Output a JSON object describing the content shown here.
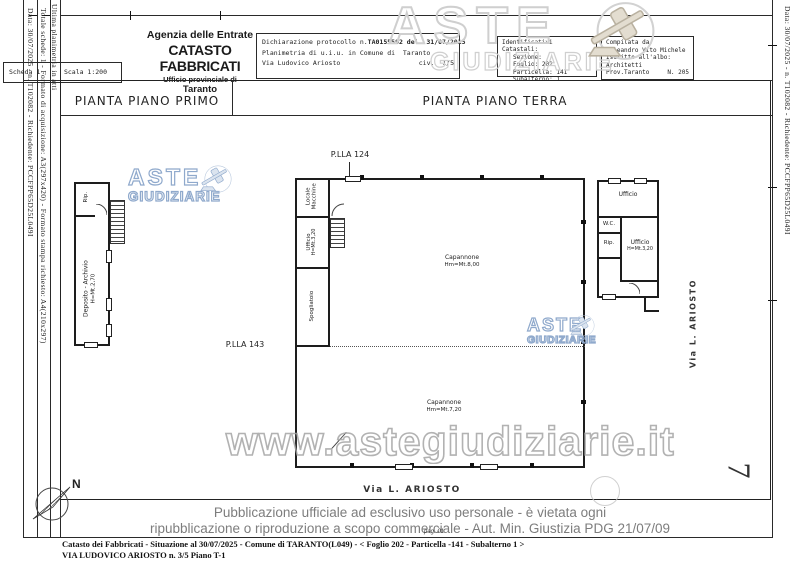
{
  "sidebar_left": {
    "col1": "Data: 30/07/2025 - n. T102082 - Richiedente: PCCFPP65D25L049I",
    "col2": "Totale schede: 1 - Formato di acquisizione: A3(297x420) - Formato stampa richiesto: A4(210x297)",
    "col3": "Ultima planimetria in atti",
    "scheda_label": "Scheda",
    "scheda_value": "1",
    "scala": "Scala 1:200"
  },
  "sidebar_right": {
    "col1": "Data: 30/07/2025 - n. T102082 - Richiedente: PCCFPP65D25L049I",
    "page_number": "7"
  },
  "header": {
    "agency": "Agenzia delle Entrate",
    "catasto": "CATASTO FABBRICATI",
    "office": "Ufficio provinciale di",
    "city": "Taranto",
    "declaration": {
      "protocol_label": "Dichiarazione protocollo n.",
      "protocol_value": "TA0155592 del  31/07/2015",
      "line2": "Planimetria di u.i.u. in Comune di  Taranto",
      "street": "Via Ludovico Ariosto",
      "civ": "civ.  1/5"
    },
    "catastali": {
      "title": "Identificativi Catastali:",
      "sezione": "Sezione:",
      "foglio": "Foglio: 202",
      "particella": "Particella: 141",
      "subalterno": "Subalterno: 1"
    },
    "compilata": {
      "title": "Compilata da:",
      "name": "Galeandro Vito Michele",
      "albo_label": "Iscritto all'albo:",
      "albo_value": "Architetti",
      "prov": "Prov.Taranto",
      "num": "N. 205"
    }
  },
  "plan": {
    "first_floor": {
      "title": "PIANTA PIANO PRIMO",
      "rip": "Rip.",
      "deposito": "Deposito - Archivio",
      "deposito_h": "H=Mt.2,70"
    },
    "ground_floor": {
      "title": "PIANTA PIANO TERRA",
      "plla_top": "P.LLA 124",
      "plla_left": "P.LLA 143",
      "locale_line1": "Locale",
      "locale_line2": "Macchine",
      "ufficio_line1": "Ufficio",
      "ufficio_line2": "H=Mt.3,20",
      "spogliatoio": "Spogliatoio",
      "capannone1_line1": "Capannone",
      "capannone1_line2": "Hm=Mt.8,00",
      "capannone2_line1": "Capannone",
      "capannone2_line2": "Hm=Mt.7,20",
      "rb_ufficio_top": "Ufficio",
      "rb_wc": "W.C.",
      "rb_rip": "Rip.",
      "rb_ufficio": "Ufficio",
      "rb_ufficio_h": "H=Mt.3,20"
    },
    "via_ariosto_right": "Via  L.  ARIOSTO",
    "via_ariosto_bottom": "Via  L.  ARIOSTO",
    "north": "N"
  },
  "watermark": {
    "aste": "ASTE",
    "giudiziarie": "GIUDIZIARIE",
    "url": "www.astegiudiziarie.it",
    "color_gray": "#cfcfcf",
    "color_blue": "#8fa9cc"
  },
  "disclaimer": {
    "line1": "Pubblicazione ufficiale ad esclusivo uso personale - è vietata ogni",
    "line2": "ripubblicazione o riproduzione a scopo commerciale - Aut. Min. Giustizia PDG 21/07/09"
  },
  "footer": {
    "page_note": "pag. 01",
    "line1": "Catasto dei Fabbricati - Situazione al 30/07/2025 - Comune di TARANTO(L049) - <  Foglio 202 - Particella -141 - Subalterno 1 >",
    "line2": "VIA LUDOVICO ARIOSTO n. 3/5 Piano T-1"
  }
}
